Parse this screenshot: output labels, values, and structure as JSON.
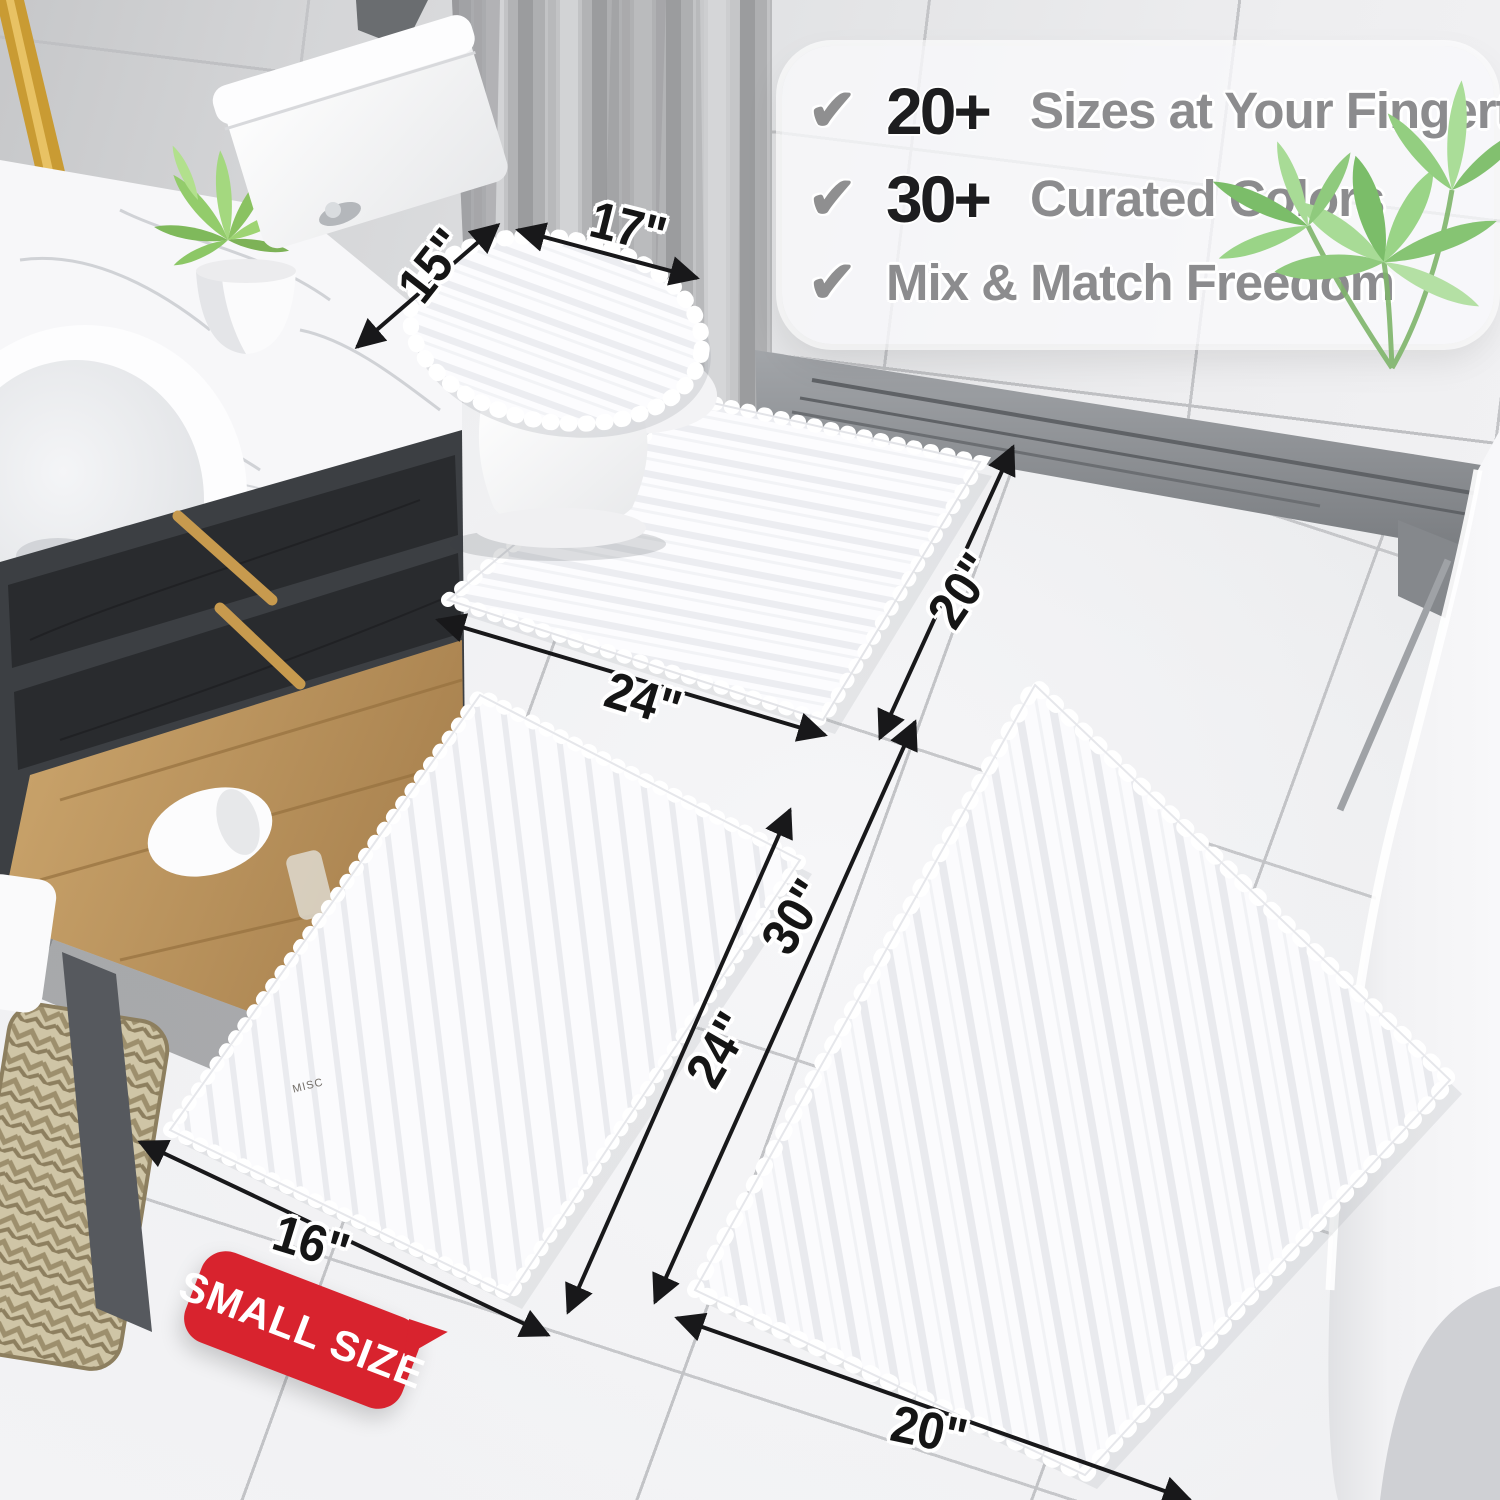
{
  "callout": {
    "items": [
      {
        "icon": "check",
        "stat": "20+",
        "label": "Sizes at Your Fingertips"
      },
      {
        "icon": "check",
        "stat": "30+",
        "label": "Curated Colors"
      },
      {
        "icon": "check",
        "stat": "",
        "label": "Mix & Match Freedom"
      }
    ]
  },
  "badge": {
    "label": "SMALL SIZE"
  },
  "dimensions": [
    {
      "part": "toilet-lid-cover",
      "side": "width",
      "text": "15\""
    },
    {
      "part": "toilet-lid-cover",
      "side": "length",
      "text": "17\""
    },
    {
      "part": "contour-mat",
      "side": "width",
      "text": "24\""
    },
    {
      "part": "contour-mat",
      "side": "depth",
      "text": "20\""
    },
    {
      "part": "small-rug",
      "side": "length",
      "text": "24\""
    },
    {
      "part": "large-rug",
      "side": "length",
      "text": "30\""
    },
    {
      "part": "small-rug",
      "side": "width",
      "text": "16\""
    },
    {
      "part": "large-rug",
      "side": "width",
      "text": "20\""
    }
  ],
  "scene": {
    "bottle_label": "MISC"
  },
  "colors": {
    "badge_bg": "#d8232e",
    "badge_text": "#ffffff",
    "stat_text": "#1d1d1f",
    "feature_text": "#8c8c8e",
    "check_icon": "#8f8f90",
    "dimension_text": "#151515",
    "rug": "#fbfbfd",
    "gold_accent": "#c79a4e"
  }
}
